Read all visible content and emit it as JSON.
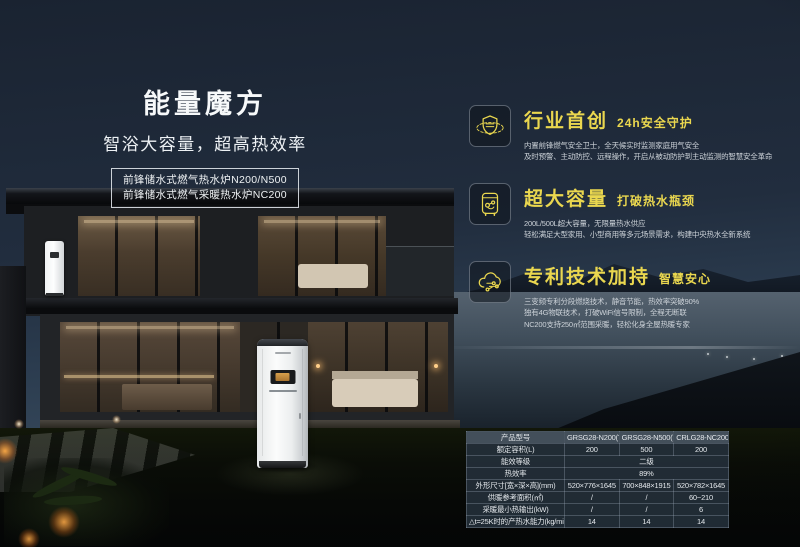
{
  "hero": {
    "title": "能量魔方",
    "subtitle": "智浴大容量，超高热效率",
    "model_lines": [
      "前锋储水式燃气热水炉N200/N500",
      "前锋储水式燃气采暖热水炉NC200"
    ]
  },
  "features": [
    {
      "icon": "shield-orbit-icon",
      "title": "行业首创",
      "tagline": "24h安全守护",
      "lines": [
        "内置前锋燃气安全卫士，全天候实时监测家庭用气安全",
        "及时预警、主动防控、远程操作，开启从被动防护到主动监测的智慧安全革命"
      ]
    },
    {
      "icon": "storage-tank-icon",
      "title": "超大容量",
      "tagline": "打破热水瓶颈",
      "lines": [
        "200L/500L超大容量，无限量热水供应",
        "轻松满足大型家用、小型商用等多元场景需求，构建中央热水全新系统"
      ]
    },
    {
      "icon": "iot-cloud-icon",
      "title": "专利技术加持",
      "tagline": "智慧安心",
      "lines": [
        "三变频专利分段燃烧技术，静音节能，热效率突破90%",
        "独有4G物联技术，打破WiFi信号限制，全程无断联",
        "NC200支持250㎡范围采暖，轻松化身全屋热暖专家"
      ]
    }
  ],
  "spec_table": {
    "rows": [
      {
        "label": "产品型号",
        "values": [
          "GRSG28-N200(T)",
          "GRSG28-N500(T)",
          "CRLG28-NC200(T)"
        ]
      },
      {
        "label": "额定容积(L)",
        "values": [
          "200",
          "500",
          "200"
        ]
      },
      {
        "label": "能效等级",
        "span": "二级"
      },
      {
        "label": "热效率",
        "span": "89%"
      },
      {
        "label": "外形尺寸[宽×深×高](mm)",
        "values": [
          "520×776×1645",
          "700×848×1915",
          "520×782×1645"
        ]
      },
      {
        "label": "供暖参考面积(㎡)",
        "values": [
          "/",
          "/",
          "60~210"
        ]
      },
      {
        "label": "采暖最小热输出(kW)",
        "values": [
          "/",
          "/",
          "6"
        ]
      },
      {
        "label": "△t=25K时的产热水能力(kg/min)",
        "values": [
          "14",
          "14",
          "14"
        ]
      }
    ]
  },
  "colors": {
    "accent_gold": "#ead74f",
    "sky": "#212d3e",
    "water": "#42505d",
    "table_bg": "rgba(38,49,61,0.85)"
  }
}
